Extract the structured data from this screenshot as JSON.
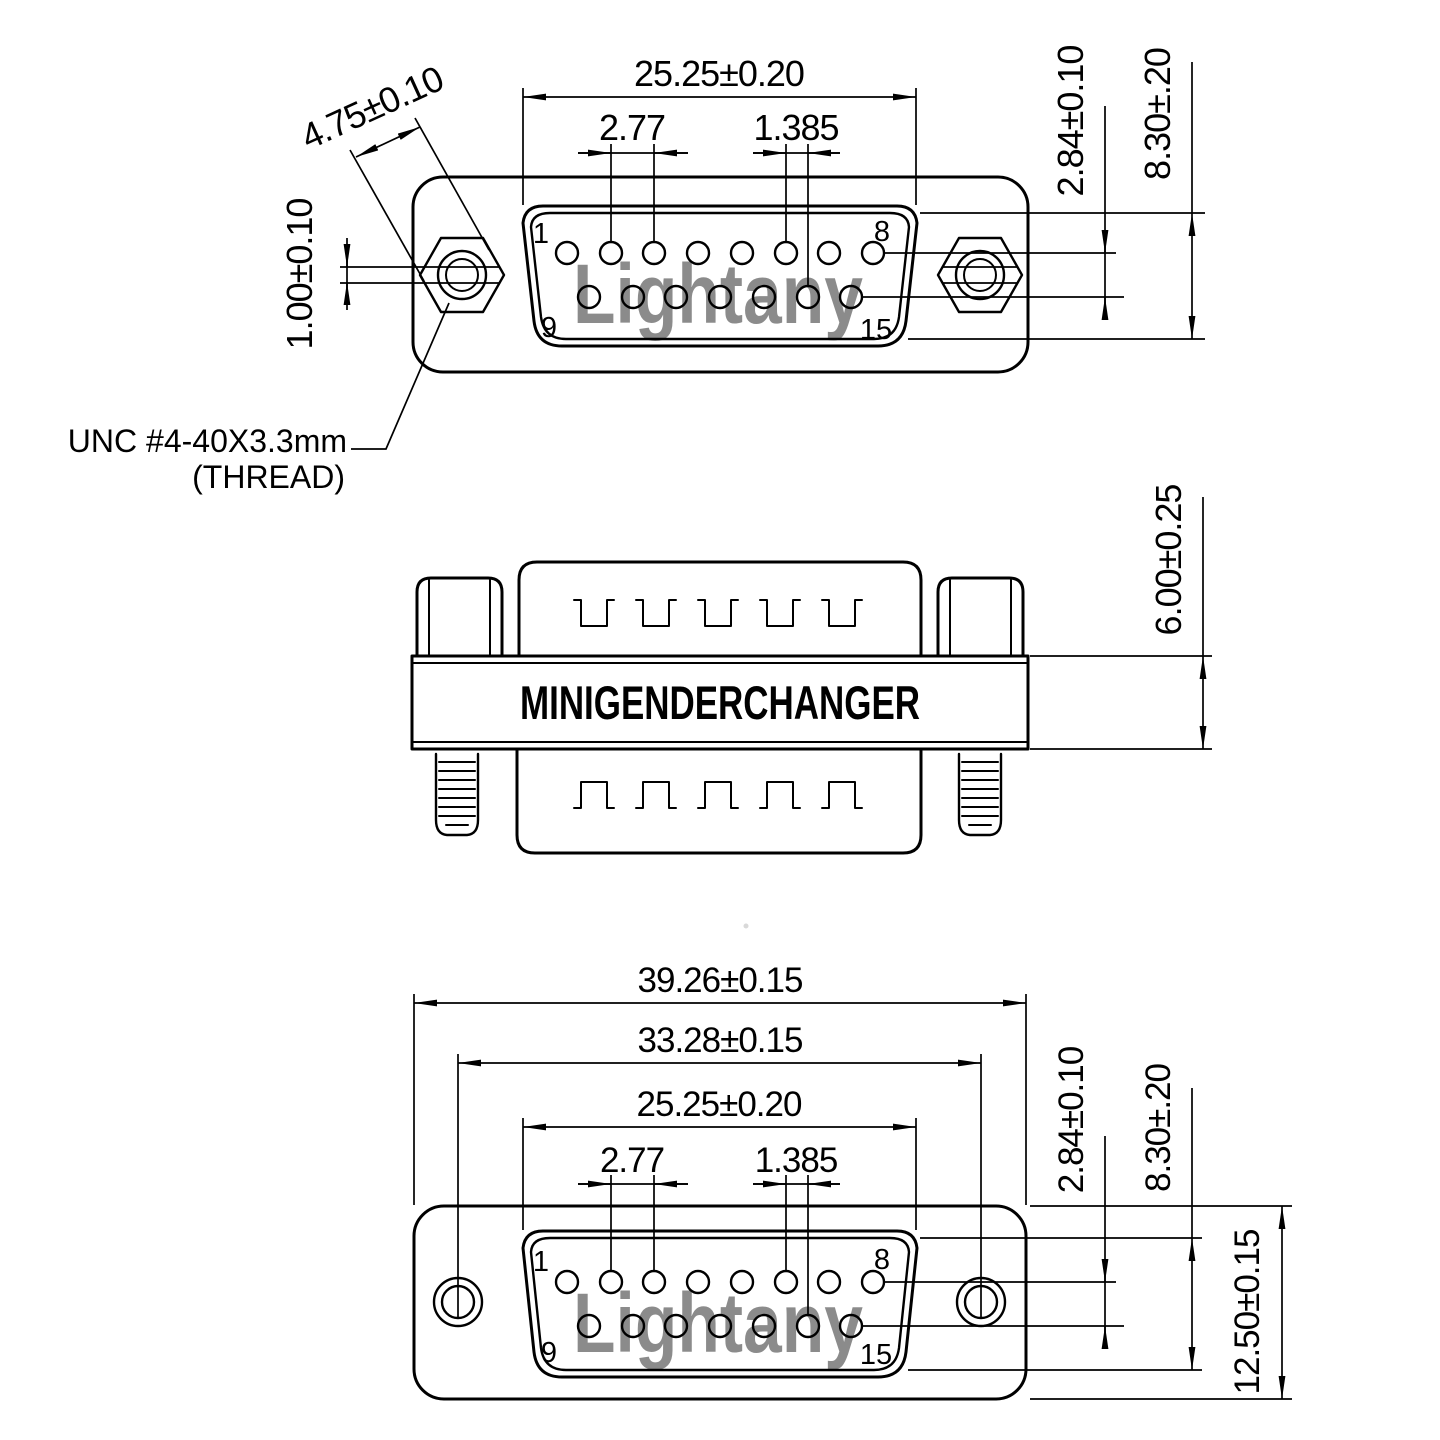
{
  "colors": {
    "line": "#000000",
    "background": "#ffffff",
    "watermark": "#f0b9b9"
  },
  "views": {
    "front_top": {
      "dim_pin_span": "25.25±0.20",
      "dim_pitch": "2.77",
      "dim_half_pitch": "1.385",
      "dim_nut_width": "4.75±0.10",
      "dim_slot": "1.00±0.10",
      "dim_row_gap": "2.84±0.10",
      "dim_shell_height": "8.30±.20",
      "thread_note_line1": "UNC #4-40X3.3mm",
      "thread_note_line2": "(THREAD)",
      "pin_1": "1",
      "pin_8": "8",
      "pin_9": "9",
      "pin_15": "15",
      "watermark": "Lightany"
    },
    "side": {
      "label": "MINIGENDERCHANGER",
      "dim_thickness": "6.00±0.25"
    },
    "front_bottom": {
      "dim_body_width": "39.26±0.15",
      "dim_hole_span": "33.28±0.15",
      "dim_pin_span": "25.25±0.20",
      "dim_pitch": "2.77",
      "dim_half_pitch": "1.385",
      "dim_row_gap": "2.84±0.10",
      "dim_shell_height": "8.30±.20",
      "dim_body_height": "12.50±0.15",
      "pin_1": "1",
      "pin_8": "8",
      "pin_9": "9",
      "pin_15": "15",
      "watermark": "Lightany"
    }
  }
}
